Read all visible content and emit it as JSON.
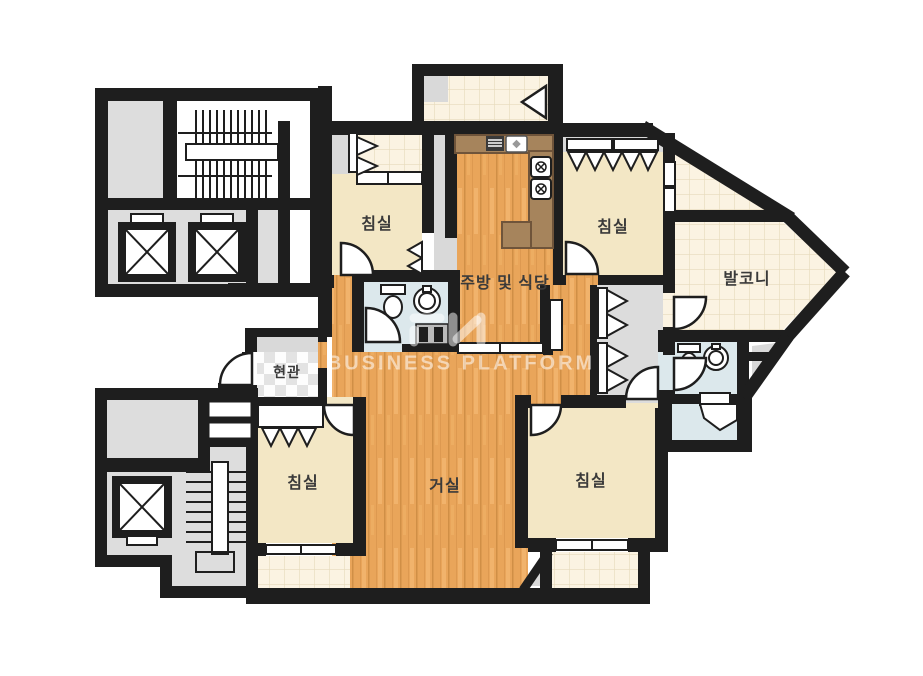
{
  "floorplan": {
    "title": "apartment-floor-plan",
    "rooms": {
      "bedroom_top_left": {
        "label": "침실"
      },
      "bedroom_top_right": {
        "label": "침실"
      },
      "bedroom_bottom_left": {
        "label": "침실"
      },
      "bedroom_bottom_right": {
        "label": "침실"
      },
      "kitchen_dining": {
        "label": "주방 및 식당"
      },
      "living_room": {
        "label": "거실"
      },
      "entrance": {
        "label": "현관"
      },
      "balcony": {
        "label": "발코니"
      }
    },
    "fixtures": [
      "stairs-icon",
      "elevator-icon",
      "toilet-icon",
      "sink-icon",
      "stove-burner-icon",
      "kitchen-counter",
      "range-hood-icon",
      "wardrobe-hanger-icon",
      "door-arc",
      "window-sill"
    ],
    "colors": {
      "wall": "#1e1e1e",
      "wood_floor": "#e9a55a",
      "bedroom_floor": "#f3e7c5",
      "tile_floor": "#fbf3e2",
      "bathroom_floor": "#dce8ec",
      "common_area": "#dddddd",
      "counter": "#a6845c"
    }
  },
  "watermark": {
    "text": "BUSINESS PLATFORM"
  }
}
